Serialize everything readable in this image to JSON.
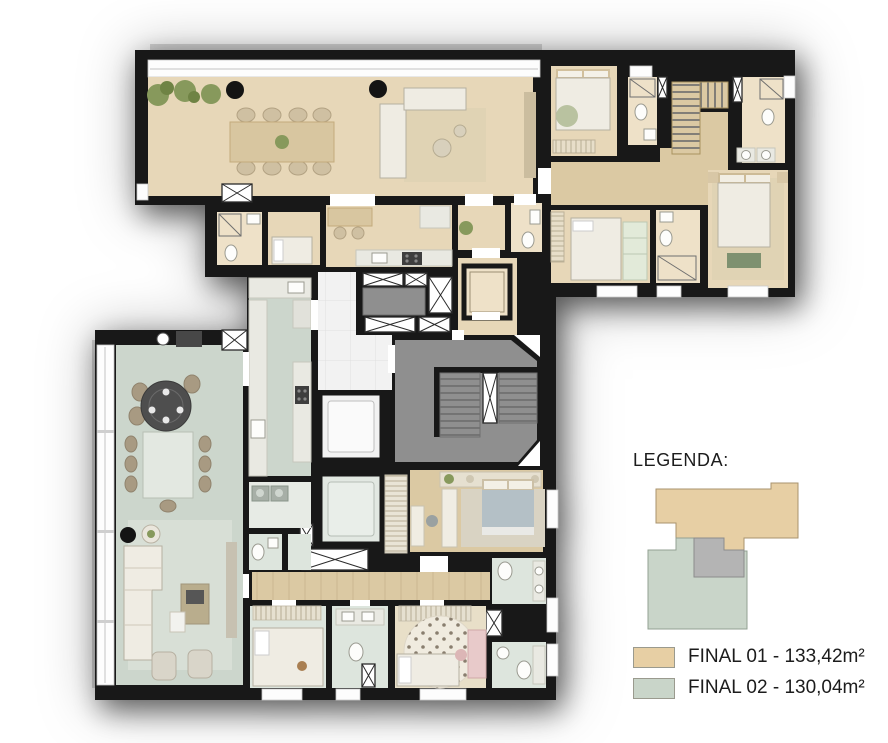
{
  "legend": {
    "title": "LEGENDA:",
    "items": [
      {
        "id": "final-01",
        "label": "FINAL 01 - 133,42m²",
        "color": "#e7cfa4"
      },
      {
        "id": "final-02",
        "label": "FINAL 02 - 130,04m²",
        "color": "#c9d5c9"
      }
    ]
  },
  "colors": {
    "wall": "#181818",
    "tan": "#e7d7b8",
    "tanLight": "#eee1c8",
    "sage": "#ccd6cc",
    "sageLight": "#dde5dd",
    "wood": "#dbc9a3",
    "woodLight": "#e8dfc8",
    "grayHall": "#8f8f8f",
    "whiteHall": "#f2f2f2",
    "glass": "#fdfdfd",
    "furniture": "#efece3",
    "rugTan": "#e0d3b4",
    "rugSage": "#d8dfd6",
    "green": "#87995c",
    "greenDark": "#6f8344",
    "bench": "#7e9170",
    "blue": "#b4c0c6",
    "pink": "#e8caca",
    "counter": "#e9e9e2",
    "dark": "#434343",
    "legendGray": "#b4b4b4"
  }
}
